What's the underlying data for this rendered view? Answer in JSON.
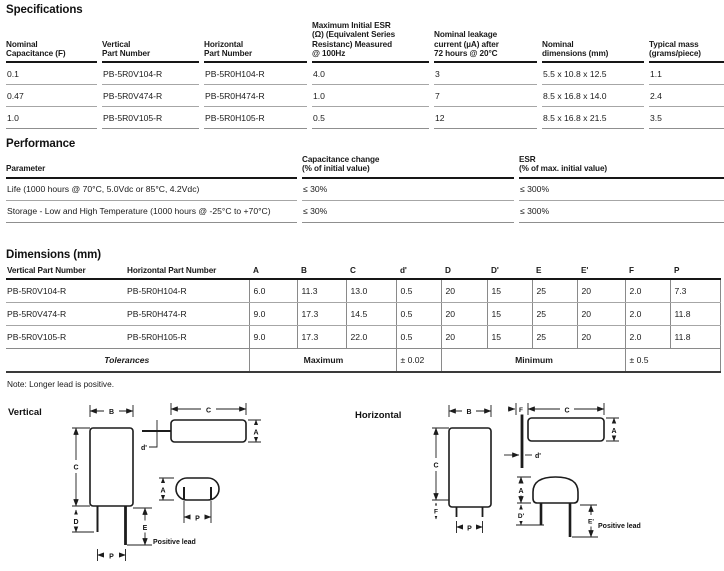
{
  "specifications": {
    "title": "Specifications",
    "headers": [
      "Nominal\nCapacitance (F)",
      "Vertical\nPart Number",
      "Horizontal\nPart Number",
      "Maximum Initial ESR\n(Ω) (Equivalent Series\nResistanc) Measured\n@ 100Hz",
      "Nominal leakage\ncurrent (µA) after\n72 hours @ 20°C",
      "Nominal\ndimensions (mm)",
      "Typical mass\n(grams/piece)"
    ],
    "rows": [
      [
        "0.1",
        "PB-5R0V104-R",
        "PB-5R0H104-R",
        "4.0",
        "3",
        "5.5 x 10.8 x 12.5",
        "1.1"
      ],
      [
        "0.47",
        "PB-5R0V474-R",
        "PB-5R0H474-R",
        "1.0",
        "7",
        "8.5 x 16.8 x 14.0",
        "2.4"
      ],
      [
        "1.0",
        "PB-5R0V105-R",
        "PB-5R0H105-R",
        "0.5",
        "12",
        "8.5 x 16.8 x 21.5",
        "3.5"
      ]
    ]
  },
  "performance": {
    "title": "Performance",
    "headers": [
      "Parameter",
      "Capacitance change\n(% of initial value)",
      "ESR\n(% of max. initial value)"
    ],
    "rows": [
      [
        "Life (1000 hours @ 70°C, 5.0Vdc or 85°C, 4.2Vdc)",
        "≤ 30%",
        "≤ 300%"
      ],
      [
        "Storage - Low and High Temperature (1000 hours @ -25°C to +70°C)",
        "≤ 30%",
        "≤ 300%"
      ]
    ]
  },
  "dimensions": {
    "title": "Dimensions (mm)",
    "headers": [
      "Vertical Part Number",
      "Horizontal Part Number",
      "A",
      "B",
      "C",
      "d'",
      "D",
      "D'",
      "E",
      "E'",
      "F",
      "P"
    ],
    "rows": [
      [
        "PB-5R0V104-R",
        "PB-5R0H104-R",
        "6.0",
        "11.3",
        "13.0",
        "0.5",
        "20",
        "15",
        "25",
        "20",
        "2.0",
        "7.3"
      ],
      [
        "PB-5R0V474-R",
        "PB-5R0H474-R",
        "9.0",
        "17.3",
        "14.5",
        "0.5",
        "20",
        "15",
        "25",
        "20",
        "2.0",
        "11.8"
      ],
      [
        "PB-5R0V105-R",
        "PB-5R0H105-R",
        "9.0",
        "17.3",
        "22.0",
        "0.5",
        "20",
        "15",
        "25",
        "20",
        "2.0",
        "11.8"
      ]
    ],
    "tolerances": {
      "label": "Tolerances",
      "max_label": "Maximum",
      "d_tolerance": "± 0.02",
      "min_label": "Minimum",
      "fp_tolerance": "± 0.5"
    },
    "note": "Note: Longer lead is positive."
  },
  "diagrams": {
    "vertical": {
      "label": "Vertical",
      "positive_lead": "Positive lead",
      "dims": {
        "A": "A",
        "B": "B",
        "C": "C",
        "D": "D",
        "E": "E",
        "P": "P",
        "d": "d'"
      }
    },
    "horizontal": {
      "label": "Horizontal",
      "positive_lead": "Positive lead",
      "dims": {
        "A": "A",
        "B": "B",
        "C": "C",
        "D2": "D'",
        "E2": "E'",
        "F": "F",
        "P": "P",
        "d": "d'"
      }
    }
  }
}
